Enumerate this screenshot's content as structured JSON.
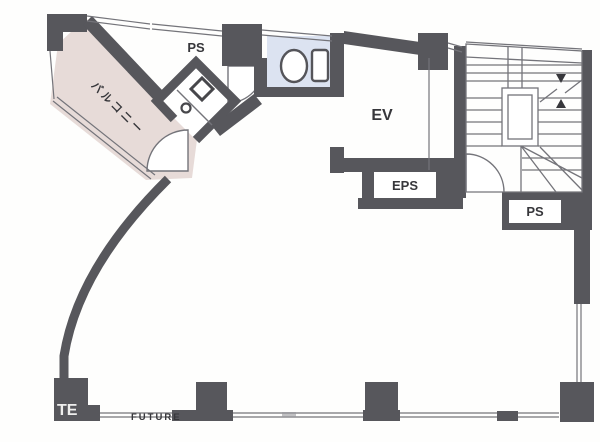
{
  "plan": {
    "labels": {
      "ps_top": "PS",
      "elevator": "EV",
      "eps": "EPS",
      "ps_right": "PS",
      "balcony": "バルコニー"
    },
    "watermark": {
      "fragment": "TE",
      "name": "FUTURE"
    },
    "colors": {
      "wall": "#57575c",
      "line": "#74747a",
      "ink": "#37373b",
      "balcony_fill": "#e7dbd8",
      "toilet_fill": "#dce3f1",
      "watermark_gray": "#9fa0a4"
    }
  }
}
